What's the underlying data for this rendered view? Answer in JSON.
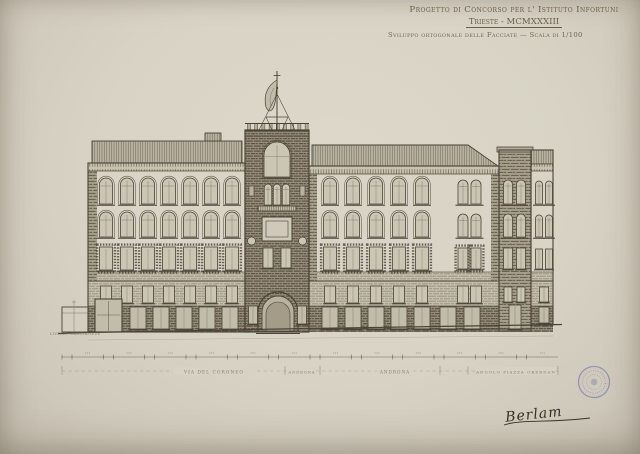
{
  "sheet": {
    "title_line1": "Progetto di Concorso per l' Istituto Infortuni",
    "title_line2": "Trieste - MCMXXXIII",
    "subtitle": "Sviluppo ortogonale delle Facciate — Scala di 1/100",
    "signature": "Berlam"
  },
  "drawing": {
    "ground_note": "LIVELLO MARCIAPIEDE",
    "street_labels": [
      {
        "text": "VIA DEL CORONEO"
      },
      {
        "text": "ANDRONA"
      },
      {
        "text": "ANDRONA"
      },
      {
        "text": "ANGOLO PIAZZA OBERDAN"
      }
    ],
    "dimension_line": {
      "tick_count": 24
    }
  },
  "stamp": {
    "type": "round-ink-stamp",
    "color": "#5c63a8"
  },
  "colors": {
    "paper": "#d7d2c4",
    "ink": "#4a4438",
    "ink_light": "#6e675a",
    "ink_faint": "#938a77",
    "wall_light": "#d9d4c6",
    "window_fill": "#cbc5b4",
    "shop_fill": "#c2bcab",
    "title_ink": "#6b5d4b",
    "stamp_blue": "#5c63a8",
    "signature_ink": "#33302a"
  }
}
